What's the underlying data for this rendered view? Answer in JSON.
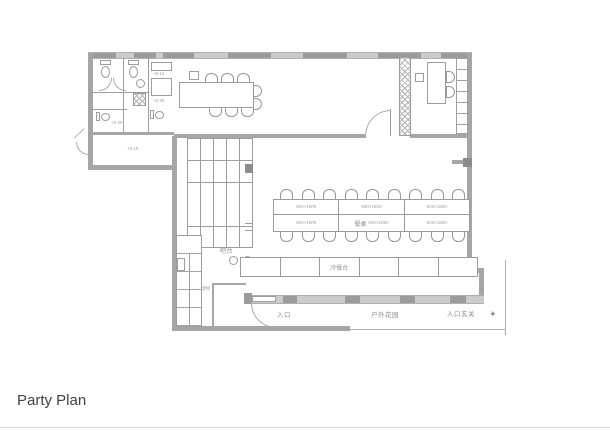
{
  "page": {
    "title": "Party Plan"
  },
  "plan": {
    "room_labels": {
      "bar": "吧台",
      "dining_table": "餐桌",
      "cold_buffet": "冷餐台",
      "entrance": "入口",
      "outdoor_garden": "户外花园",
      "entrance_foyer": "入口玄关",
      "storage": "储物"
    },
    "annotations": {
      "table_dim": "600×1800",
      "level_a": "+0.10",
      "level_b": "+0.30",
      "level_c": "+0.30",
      "level_d": "+0.15"
    },
    "symbols": {
      "north": "✦"
    },
    "colors": {
      "wall": "#a6a6a6",
      "line": "#9b9b9b",
      "window_light": "#cbcbcb",
      "ink": "#414141"
    }
  }
}
